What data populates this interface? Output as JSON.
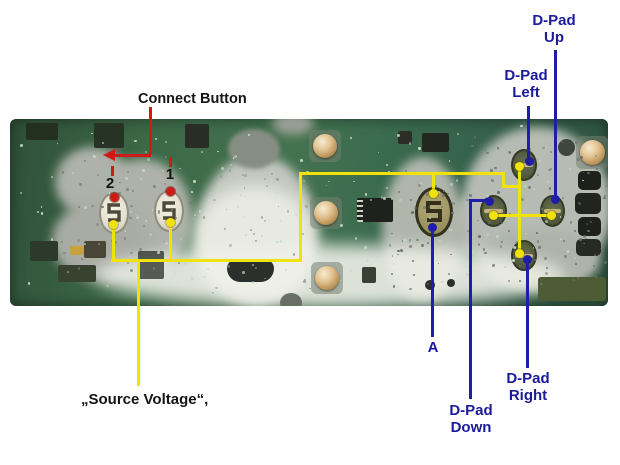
{
  "figure": {
    "description": "Annotated photograph of a handheld game controller circuit board (button-contact side) with wiring call-outs"
  },
  "annotations": {
    "connect": {
      "label": "Connect Button"
    },
    "button2": {
      "label": "2"
    },
    "button1": {
      "label": "1"
    },
    "source_voltage": {
      "label": "„Source Voltage“,"
    },
    "a": {
      "label": "A"
    },
    "dpad_up": {
      "line1": "D-Pad",
      "line2": "Up"
    },
    "dpad_left": {
      "line1": "D-Pad",
      "line2": "Left"
    },
    "dpad_down": {
      "line1": "D-Pad",
      "line2": "Down"
    },
    "dpad_right": {
      "line1": "D-Pad",
      "line2": "Right"
    }
  },
  "colors": {
    "annotation_yellow": "#f0e20a",
    "annotation_blue": "#1e1ea8",
    "annotation_red": "#cf1b15",
    "text_blue": "#1b1b9c",
    "text_black": "#141414",
    "pcb_green": "#3c6a49",
    "membrane_gray": "#b2b8ae",
    "dome_gold": "#d8b987"
  }
}
